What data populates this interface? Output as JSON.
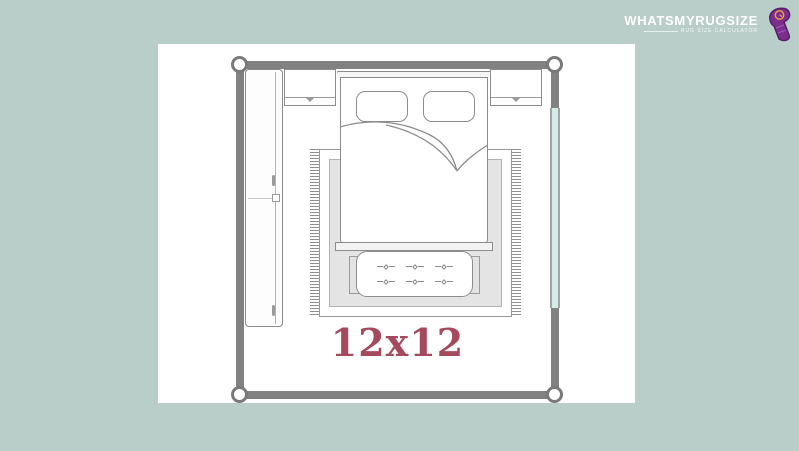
{
  "logo": {
    "title": "WHATSMYRUGSIZE",
    "tagline": "RUG SIZE CALCULATOR",
    "icon": "rolled-rug-icon"
  },
  "floorplan": {
    "label": "12x12",
    "room_type": "bedroom-floor-plan",
    "furniture": [
      "wardrobe",
      "bed",
      "pillows",
      "nightstand-left",
      "nightstand-right",
      "bench",
      "rug",
      "window"
    ],
    "bench": {
      "tuft_rows": 2,
      "tuft_cols": 3
    }
  },
  "colors": {
    "background": "#b9cec9",
    "panel": "#ffffff",
    "wall": "#818181",
    "line": "#8c8c8c",
    "rug_inner": "#e4e4e4",
    "window": "#d3ece8",
    "label": "#a54a5c",
    "logo_purple": "#7b2e8c",
    "logo_accent": "#e8a33d",
    "logo_text": "#ffffff"
  }
}
